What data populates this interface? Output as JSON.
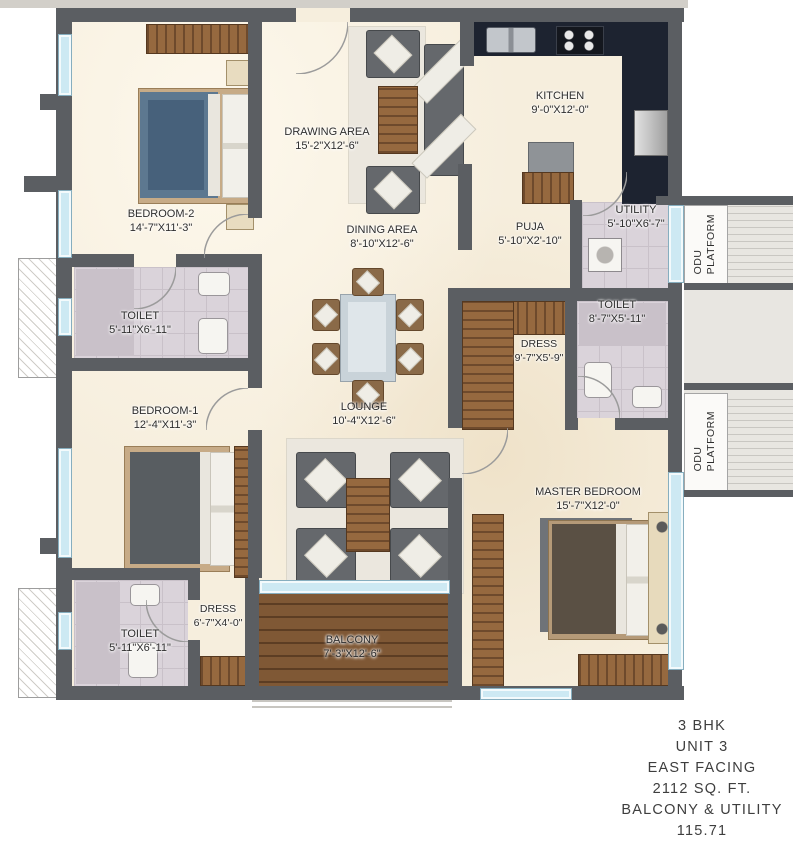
{
  "plan": {
    "rooms": {
      "bedroom2": {
        "name": "BEDROOM-2",
        "dims": "14'-7\"X11'-3\""
      },
      "drawing_area": {
        "name": "DRAWING AREA",
        "dims": "15'-2\"X12'-6\""
      },
      "kitchen": {
        "name": "KITCHEN",
        "dims": "9'-0\"X12'-0\""
      },
      "dining_area": {
        "name": "DINING AREA",
        "dims": "8'-10\"X12'-6\""
      },
      "puja": {
        "name": "PUJA",
        "dims": "5'-10\"X2'-10\""
      },
      "utility": {
        "name": "UTILITY",
        "dims": "5'-10\"X6'-7\""
      },
      "toilet_left": {
        "name": "TOILET",
        "dims": "5'-11\"X6'-11\""
      },
      "toilet_right": {
        "name": "TOILET",
        "dims": "8'-7\"X5'-11\""
      },
      "dress_right": {
        "name": "DRESS",
        "dims": "9'-7\"X5'-9\""
      },
      "bedroom1": {
        "name": "BEDROOM-1",
        "dims": "12'-4\"X11'-3\""
      },
      "lounge": {
        "name": "LOUNGE",
        "dims": "10'-4\"X12'-6\""
      },
      "master_bedroom": {
        "name": "MASTER BEDROOM",
        "dims": "15'-7\"X12'-0\""
      },
      "toilet_bottom": {
        "name": "TOILET",
        "dims": "5'-11\"X6'-11\""
      },
      "dress_bottom": {
        "name": "DRESS",
        "dims": "6'-7\"X4'-0\""
      },
      "balcony": {
        "name": "BALCONY",
        "dims": "7'-3\"X12'-6\""
      }
    },
    "odu_platform": {
      "word1": "ODU",
      "word2": "PLATFORM"
    }
  },
  "annotation": {
    "lines": [
      "3 BHK",
      "UNIT 3",
      "EAST FACING",
      "2112 SQ. FT.",
      "BALCONY & UTILITY",
      "115.71"
    ]
  },
  "colors": {
    "wall": "#5b5e62",
    "floor": "#f6eedd",
    "wood": "#8a5f3c",
    "kitchen_counter": "#1d2330",
    "window": "#cde9f3",
    "deck": "#7f5835",
    "toilet_tile": "#dad3da",
    "label_text": "#2e2e2e"
  }
}
